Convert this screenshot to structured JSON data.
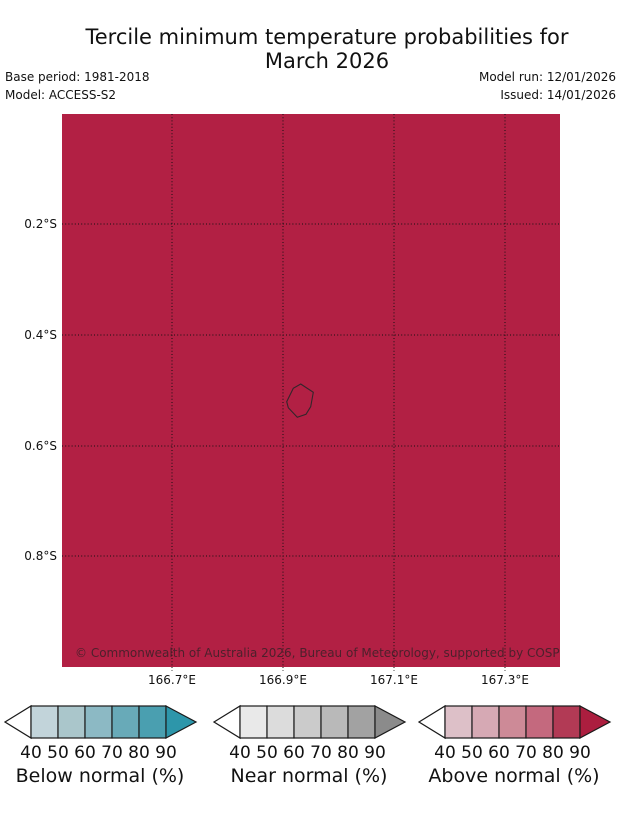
{
  "title": {
    "line1": "Tercile minimum temperature probabilities for",
    "line2": "March 2026"
  },
  "meta": {
    "base_period": "Base period: 1981-2018",
    "model": "Model: ACCESS-S2",
    "model_run": "Model run: 12/01/2026",
    "issued": "Issued: 14/01/2026"
  },
  "map": {
    "fill_color": "#b22044",
    "copyright": "© Commonwealth of Australia 2026, Bureau of Meteorology, supported by COSPPac",
    "island": "Nauru coastline outline",
    "island_outline_color": "#33262b",
    "gridline_color": "#111111"
  },
  "chart_data": {
    "type": "heatmap",
    "title": "Tercile minimum temperature probabilities for March 2026",
    "region": "Nauru",
    "field_note": "Uniform crimson fill over entire domain indicating above-normal tercile probability in the >90% class",
    "map_fill_color": "#b22044",
    "grid": true,
    "x_ticks": [
      "166.7°E",
      "166.9°E",
      "167.1°E",
      "167.3°E"
    ],
    "y_ticks": [
      "0.2°S",
      "0.4°S",
      "0.6°S",
      "0.8°S"
    ],
    "x_range": [
      "166.5°E",
      "167.4°E"
    ],
    "y_range": [
      "0.0°S",
      "1.0°S"
    ],
    "island_outline_rel_px": [
      [
        238.7,
        270
      ],
      [
        251.3,
        278.3
      ],
      [
        248.7,
        292.7
      ],
      [
        244,
        300.3
      ],
      [
        235.3,
        303.3
      ],
      [
        226.3,
        293.7
      ],
      [
        224.7,
        287.7
      ],
      [
        231.3,
        274.3
      ]
    ],
    "colorbars": [
      {
        "label": "Below normal (%)",
        "ticks": [
          40,
          50,
          60,
          70,
          80,
          90
        ],
        "segment_colors": [
          "#c2d4da",
          "#aac6cb",
          "#8cb9c4",
          "#68aab8",
          "#4a9fb0"
        ],
        "over_color": "#2d96aa",
        "under_color": "#ffffff"
      },
      {
        "label": "Near normal (%)",
        "ticks": [
          40,
          50,
          60,
          70,
          80,
          90
        ],
        "segment_colors": [
          "#e9e9e9",
          "#dcdcdc",
          "#cbcbcb",
          "#b9b9b9",
          "#a2a2a2"
        ],
        "over_color": "#8b8b8b",
        "under_color": "#ffffff"
      },
      {
        "label": "Above normal (%)",
        "ticks": [
          40,
          50,
          60,
          70,
          80,
          90
        ],
        "segment_colors": [
          "#ddc0c8",
          "#d6a9b4",
          "#cd8a97",
          "#c4697e",
          "#b23a55"
        ],
        "over_color": "#ac1e3f",
        "under_color": "#ffffff"
      }
    ],
    "legend_position": "bottom"
  }
}
